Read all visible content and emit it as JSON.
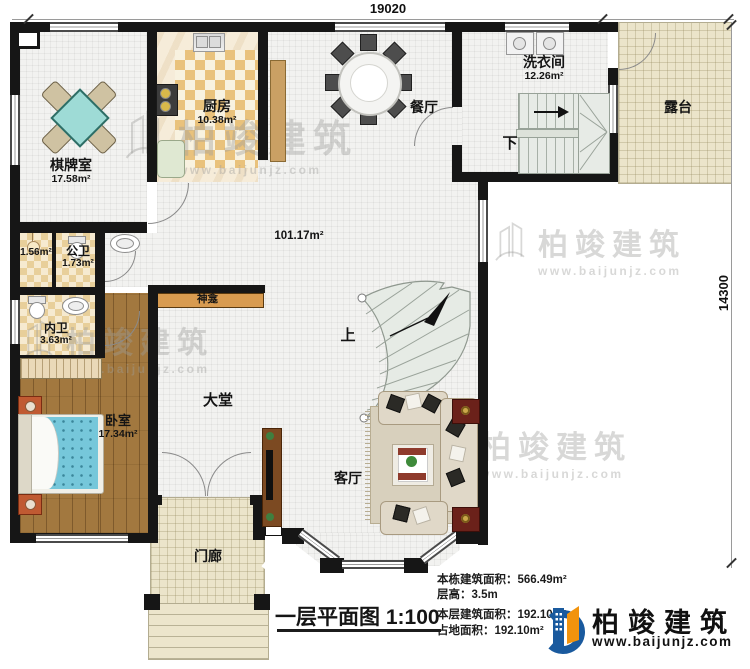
{
  "dimensions": {
    "top": "19020",
    "right": "14300"
  },
  "rooms": {
    "chess": {
      "name": "棋牌室",
      "area": "17.58m²"
    },
    "kitchen": {
      "name": "厨房",
      "area": "10.38m²"
    },
    "dining": {
      "name": "餐厅"
    },
    "laundry": {
      "name": "洗衣间",
      "area": "12.26m²"
    },
    "terrace": {
      "name": "露台"
    },
    "hall_area": "101.17m²",
    "small_room_area": "1.56m²",
    "public_bath": {
      "name": "公卫",
      "area": "1.73m²"
    },
    "ensuite_bath": {
      "name": "内卫",
      "area": "3.63m²"
    },
    "bedroom": {
      "name": "卧室",
      "area": "17.34m²"
    },
    "hall": {
      "name": "大堂"
    },
    "living": {
      "name": "客厅"
    },
    "porch": {
      "name": "门廊"
    },
    "shrine": {
      "name": "神龛"
    }
  },
  "stairs": {
    "up": "上",
    "down": "下"
  },
  "title": {
    "text": "一层平面图",
    "scale": "1:100"
  },
  "info": {
    "lines": [
      {
        "label": "本栋建筑面积：",
        "value": "566.49m²"
      },
      {
        "label": "层高：",
        "value": "3.5m"
      },
      {
        "label": "本层建筑面积：",
        "value": "192.10m²"
      },
      {
        "label": "占地面积：",
        "value": "192.10m²"
      }
    ]
  },
  "brand": {
    "name": "柏竣建筑",
    "url": "www.baijunjz.com"
  },
  "watermark": {
    "name": "柏竣建筑",
    "url": "www.baijunjz.com"
  },
  "colors": {
    "wall": "#161616",
    "logo_blue": "#1a5a9e",
    "logo_orange": "#f2930d",
    "floor_tile": "#f2f2f0",
    "wood": "#a2783f",
    "terrace": "#ebe4ca",
    "stairs": "#e6ebe5",
    "bed": "#76c7da",
    "chess_table": "#9edbd6"
  }
}
